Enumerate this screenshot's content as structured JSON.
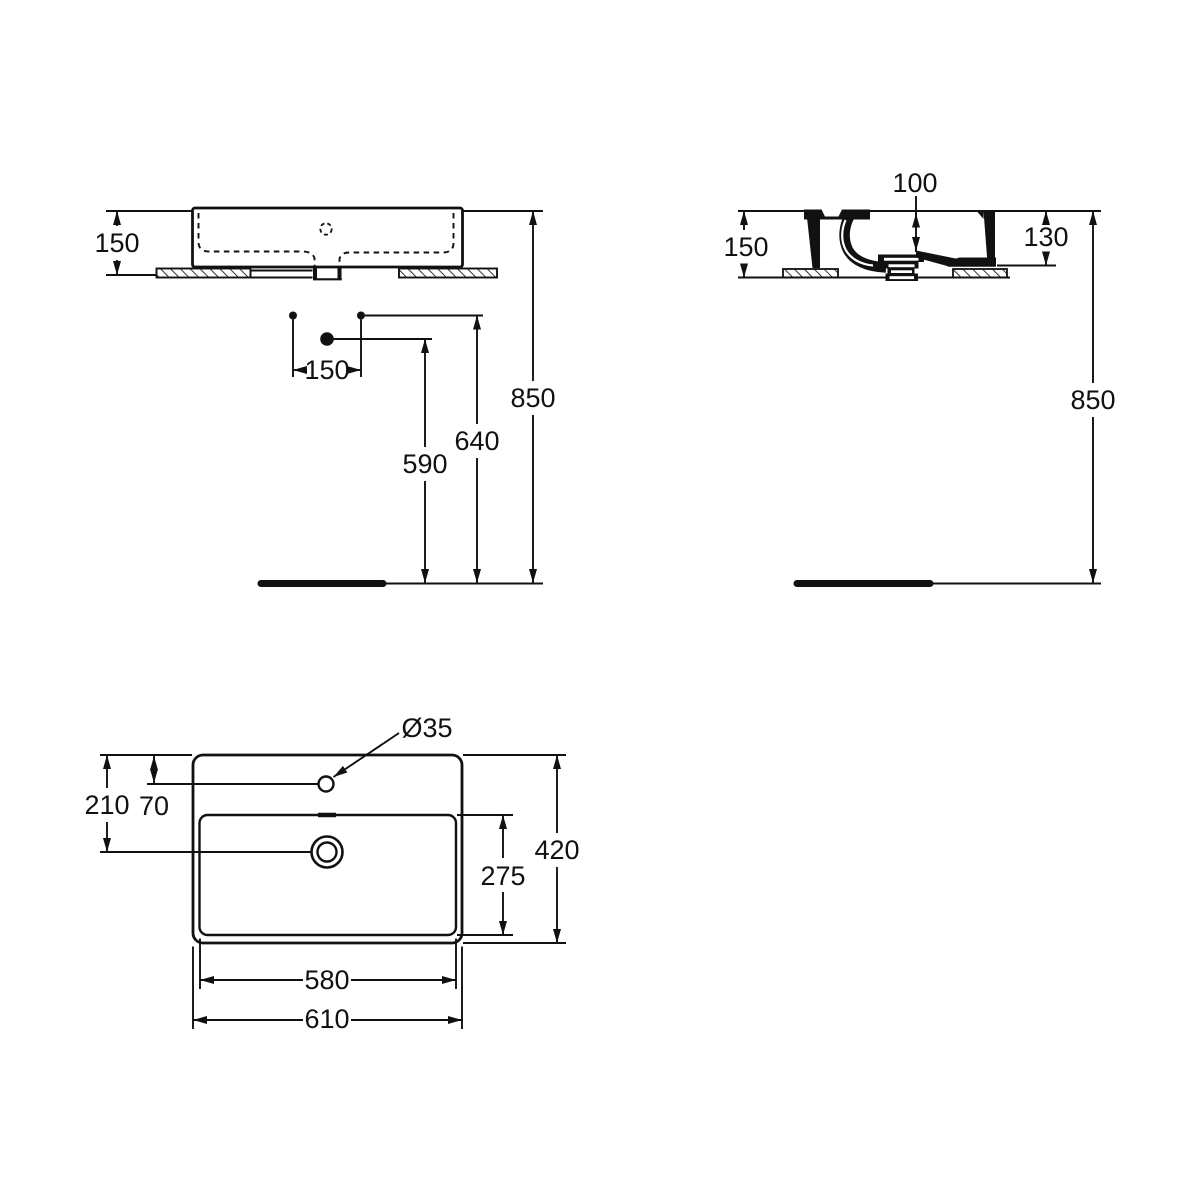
{
  "colors": {
    "line": "#111111",
    "background": "#ffffff"
  },
  "views": {
    "front": {
      "dims": {
        "height": "150",
        "tap_hole_spacing": "150",
        "drain_height": "590",
        "hole_height": "640",
        "rim_height": "850"
      }
    },
    "side": {
      "dims": {
        "bowl_depth": "100",
        "height": "150",
        "apron_height": "130",
        "rim_height": "850"
      }
    },
    "plan": {
      "dims": {
        "tap_hole_diameter": "Ø35",
        "edge_to_drain": "210",
        "edge_to_tap_hole": "70",
        "overall_depth": "420",
        "bowl_depth": "275",
        "bowl_width": "580",
        "overall_width": "610"
      }
    }
  }
}
